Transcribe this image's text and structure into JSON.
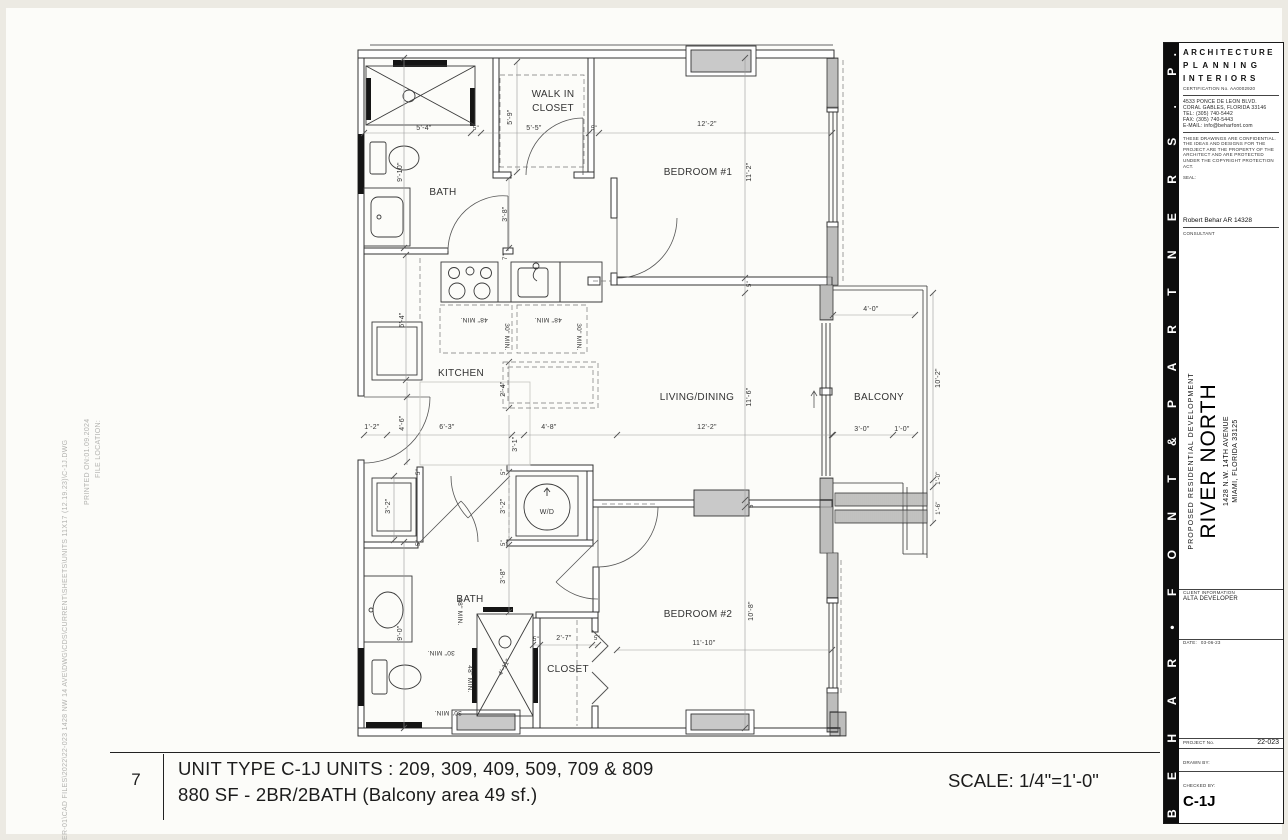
{
  "titlebar": {
    "number": "7",
    "line1": "UNIT TYPE  C-1J  UNITS : 209, 309, 409, 509, 709 & 809",
    "line2": "880 SF  - 2BR/2BATH (Balcony area 49 sf.)",
    "scale": "SCALE: 1/4\"=1'-0\""
  },
  "file_info": {
    "label": "FILE LOCATION:",
    "path": "ER-01\\CAD FILES\\2022\\22-023 1428 NW 14 AVE\\DWG\\CDS\\CURRENT\\SHEETS\\UNITS 11X17 (12.19.23)\\C-1J.DWG",
    "printed": "PRINTED ON:01.09.2024"
  },
  "sidebar": {
    "strip_text": "B E H A R • F O N T  &  P A R T N E R S  .  P. A .",
    "header1": "ARCHITECTURE",
    "header2": "PLANNING",
    "header3": "INTERIORS",
    "certification": "CERTIFICATION No. AA0002920",
    "address1": "4533 PONCE DE LEON BLVD.",
    "address2": "CORAL GABLES, FLORIDA 33146",
    "address3": "TEL: (305) 740-5442",
    "address4": "FAX: (305) 740-5443",
    "address5": "E-MAIL: info@beharfont.com",
    "disclaimer": "THESE DRAWINGS ARE CONFIDENTIAL. THE IDEAS AND DESIGNS FOR THE PROJECT ARE THE PROPERTY OF THE ARCHITECT AND ARE PROTECTED UNDER THE COPYRIGHT PROTECTION ACT.",
    "seal_label": "SEAL:",
    "architect": "Robert Behar   AR 14328",
    "consultant_label": "CONSULTANT",
    "project_type": "PROPOSED RESIDENTIAL DEVELOPMENT",
    "project_name": "RIVER NORTH",
    "project_address1": "1428 N.W. 14TH AVENUE",
    "project_address2": "MIAMI, FLORIDA 33125",
    "client_label": "CLIENT INFORMATION",
    "client": "ALTA DEVELOPER",
    "date_label": "DATE:",
    "date": "03-06-23",
    "project_no_label": "PROJECT No.",
    "project_no": "22-023",
    "drawn_by_label": "DRAWN BY:",
    "checked_by_label": "CHECKED BY:",
    "sheet": "C-1J"
  },
  "plan": {
    "texts": [
      {
        "t": "BATH",
        "x": 443,
        "y": 195,
        "s": 10,
        "n": "room-label-bath-1"
      },
      {
        "t": "WALK IN",
        "x": 553,
        "y": 97,
        "s": 10,
        "n": "room-label-walkin-1"
      },
      {
        "t": "CLOSET",
        "x": 553,
        "y": 111,
        "s": 10,
        "n": "room-label-walkin-2"
      },
      {
        "t": "BEDROOM #1",
        "x": 698,
        "y": 175,
        "s": 10,
        "n": "room-label-bedroom1"
      },
      {
        "t": "KITCHEN",
        "x": 461,
        "y": 376,
        "s": 10,
        "n": "room-label-kitchen"
      },
      {
        "t": "LIVING/DINING",
        "x": 697,
        "y": 400,
        "s": 10,
        "n": "room-label-living"
      },
      {
        "t": "BALCONY",
        "x": 879,
        "y": 400,
        "s": 10,
        "n": "room-label-balcony"
      },
      {
        "t": "BATH",
        "x": 470,
        "y": 602,
        "s": 10,
        "n": "room-label-bath-2"
      },
      {
        "t": "CLOSET",
        "x": 568,
        "y": 672,
        "s": 10,
        "n": "room-label-closet"
      },
      {
        "t": "BEDROOM #2",
        "x": 698,
        "y": 617,
        "s": 10,
        "n": "room-label-bedroom2"
      },
      {
        "t": "W/D",
        "x": 547,
        "y": 514,
        "s": 7,
        "n": "washer-dryer-label"
      },
      {
        "t": "5'-4\"",
        "x": 424,
        "y": 130
      },
      {
        "t": "5\"",
        "x": 476,
        "y": 130,
        "s": 6
      },
      {
        "t": "5'-5\"",
        "x": 534,
        "y": 130
      },
      {
        "t": "5\"",
        "x": 594,
        "y": 130,
        "s": 6
      },
      {
        "t": "12'-2\"",
        "x": 707,
        "y": 126
      },
      {
        "t": "5'-9\"",
        "x": 512,
        "y": 117,
        "r": -90
      },
      {
        "t": "9'-10\"",
        "x": 402,
        "y": 172,
        "r": -90
      },
      {
        "t": "3'-8\"",
        "x": 507,
        "y": 214,
        "r": -90
      },
      {
        "t": "7\"",
        "x": 507,
        "y": 257,
        "r": -90,
        "s": 6
      },
      {
        "t": "11'-2\"",
        "x": 751,
        "y": 172,
        "r": -90
      },
      {
        "t": "5\"",
        "x": 751,
        "y": 284,
        "r": -90,
        "s": 6
      },
      {
        "t": "6'-4\"",
        "x": 404,
        "y": 320,
        "r": -90
      },
      {
        "t": "48\" MIN.",
        "x": 474,
        "y": 318,
        "r": 180,
        "s": 6.5
      },
      {
        "t": "48\" MIN.",
        "x": 548,
        "y": 318,
        "r": 180,
        "s": 6.5
      },
      {
        "t": "30\" MIN.",
        "x": 505,
        "y": 337,
        "r": 90,
        "s": 6.5
      },
      {
        "t": "30\" MIN.",
        "x": 577,
        "y": 337,
        "r": 90,
        "s": 6.5
      },
      {
        "t": "2'-4\"",
        "x": 505,
        "y": 389,
        "r": -90
      },
      {
        "t": "11'-6\"",
        "x": 751,
        "y": 397,
        "r": -90
      },
      {
        "t": "1'-2\"",
        "x": 372,
        "y": 429
      },
      {
        "t": "4'-6\"",
        "x": 404,
        "y": 423,
        "r": -90
      },
      {
        "t": "6'-3\"",
        "x": 447,
        "y": 429
      },
      {
        "t": "3'-1\"",
        "x": 517,
        "y": 444,
        "r": -90
      },
      {
        "t": "4'-8\"",
        "x": 549,
        "y": 429
      },
      {
        "t": "12'-2\"",
        "x": 707,
        "y": 429
      },
      {
        "t": "4'-0\"",
        "x": 871,
        "y": 311
      },
      {
        "t": "10'-2\"",
        "x": 940,
        "y": 378,
        "r": -90
      },
      {
        "t": "3'-0\"",
        "x": 862,
        "y": 431
      },
      {
        "t": "1'-0\"",
        "x": 902,
        "y": 431
      },
      {
        "t": "1'-0\"",
        "x": 940,
        "y": 478,
        "r": -90,
        "s": 6
      },
      {
        "t": "1'-6\"",
        "x": 940,
        "y": 508,
        "r": -90,
        "s": 6
      },
      {
        "t": "3'-2\"",
        "x": 390,
        "y": 506,
        "r": -90
      },
      {
        "t": "3'-2\"",
        "x": 505,
        "y": 506,
        "r": -90
      },
      {
        "t": "5\"",
        "x": 420,
        "y": 472,
        "r": -90,
        "s": 6
      },
      {
        "t": "5\"",
        "x": 505,
        "y": 472,
        "r": -90,
        "s": 6
      },
      {
        "t": "5\"",
        "x": 420,
        "y": 543,
        "r": -90,
        "s": 6
      },
      {
        "t": "5\"",
        "x": 505,
        "y": 543,
        "r": -90,
        "s": 6
      },
      {
        "t": "3'-8\"",
        "x": 505,
        "y": 576,
        "r": -90
      },
      {
        "t": "9'-0\"",
        "x": 402,
        "y": 633,
        "r": -90
      },
      {
        "t": "30\" MIN.",
        "x": 441,
        "y": 651,
        "r": 180,
        "s": 6.5
      },
      {
        "t": "30\" MIN.",
        "x": 448,
        "y": 711,
        "r": 180,
        "s": 6.5
      },
      {
        "t": "48\" MIN.",
        "x": 458,
        "y": 612,
        "r": 90,
        "s": 6.5
      },
      {
        "t": "48\" MIN.",
        "x": 468,
        "y": 679,
        "r": 90,
        "s": 6.5
      },
      {
        "t": "4'-11\"",
        "x": 506,
        "y": 668,
        "r": -61,
        "s": 6.5
      },
      {
        "t": "5\"",
        "x": 536,
        "y": 641,
        "s": 6
      },
      {
        "t": "2'-7\"",
        "x": 564,
        "y": 640
      },
      {
        "t": "5\"",
        "x": 597,
        "y": 640,
        "s": 6
      },
      {
        "t": "10'-8\"",
        "x": 753,
        "y": 611,
        "r": -90
      },
      {
        "t": "11'-10\"",
        "x": 704,
        "y": 645
      },
      {
        "t": "5\"",
        "x": 753,
        "y": 505,
        "r": -90,
        "s": 6
      }
    ]
  }
}
